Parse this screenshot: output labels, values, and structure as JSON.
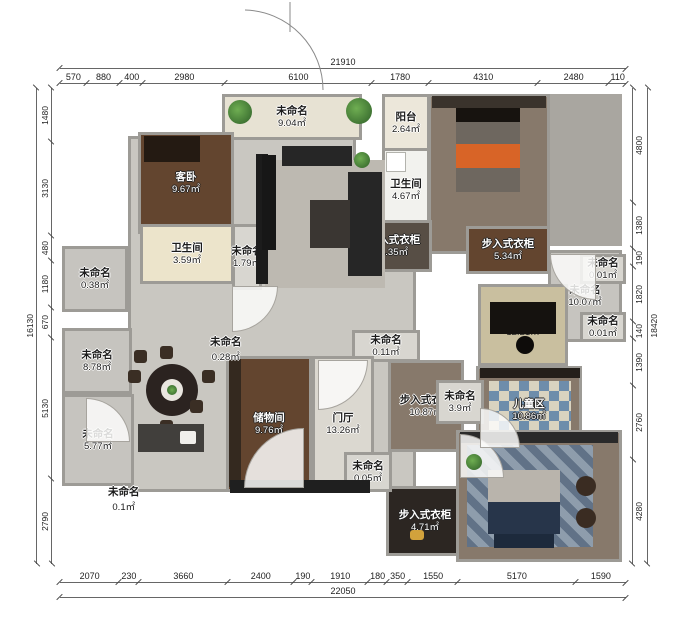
{
  "plan": {
    "type": "residential-floor-plan",
    "unit": "mm"
  },
  "dims": {
    "top": {
      "total": "21910",
      "segments": [
        "570",
        "880",
        "400",
        "2980",
        "6100",
        "1780",
        "4310",
        "2480",
        "110"
      ]
    },
    "bottom": {
      "total": "22050",
      "segments": [
        "2070",
        "230",
        "3660",
        "2400",
        "190",
        "1910",
        "180",
        "350",
        "1550",
        "5170",
        "1590"
      ]
    },
    "left": {
      "total": "16130",
      "segments": [
        "1480",
        "3130",
        "480",
        "1180",
        "670",
        "5130",
        "2790"
      ]
    },
    "right": {
      "total": "18420",
      "segments": [
        "4800",
        "1380",
        "190",
        "1820",
        "140",
        "1390",
        "2760",
        "4280"
      ]
    }
  },
  "rooms": [
    {
      "label": "未命名",
      "area": "9.04㎡"
    },
    {
      "label": "阳台",
      "area": "2.64㎡"
    },
    {
      "label": "女儿房",
      "area": "22.85㎡"
    },
    {
      "label": "客卧",
      "area": "9.67㎡"
    },
    {
      "label": "卫生间",
      "area": "4.67㎡"
    },
    {
      "label": "卫生间",
      "area": "3.59㎡"
    },
    {
      "label": "未命名",
      "area": "1.79㎡"
    },
    {
      "label": "未命名",
      "area": "0.38㎡"
    },
    {
      "label": "步入式衣柜",
      "area": "4.35㎡"
    },
    {
      "label": "步入式衣柜",
      "area": "5.34㎡"
    },
    {
      "label": "未命名",
      "area": "0.01㎡"
    },
    {
      "label": "未命名",
      "area": "10.07㎡"
    },
    {
      "label": "未命名",
      "area": "0.01㎡"
    },
    {
      "label": "客餐厅",
      "area": "90.07㎡"
    },
    {
      "label": "书房",
      "area": "12.21㎡"
    },
    {
      "label": "未命名",
      "area": "8.78㎡"
    },
    {
      "label": "未命名",
      "area": "0.28㎡"
    },
    {
      "label": "未命名",
      "area": "0.11㎡"
    },
    {
      "label": "储物间",
      "area": "9.76㎡"
    },
    {
      "label": "门厅",
      "area": "13.26㎡"
    },
    {
      "label": "步入式衣柜",
      "area": "10.87㎡"
    },
    {
      "label": "未命名",
      "area": "3.9㎡"
    },
    {
      "label": "儿童区",
      "area": "10.86㎡"
    },
    {
      "label": "未命名",
      "area": "5.77㎡"
    },
    {
      "label": "未命名",
      "area": "0.1㎡"
    },
    {
      "label": "未命名",
      "area": "0.05㎡"
    },
    {
      "label": "步入式衣柜",
      "area": "4.71㎡"
    },
    {
      "label": "主卧",
      "area": "22.11㎡"
    }
  ],
  "colors": {
    "wall": "#9d9b96",
    "living_floor": "#c9c7c1",
    "wood_dark": "#63452f",
    "wood_gray": "#87796b",
    "bed_accent_orange": "#d86427",
    "rug_blue": "#5a718c",
    "plant_green": "#3f7d3a",
    "dim_line": "#666666"
  }
}
